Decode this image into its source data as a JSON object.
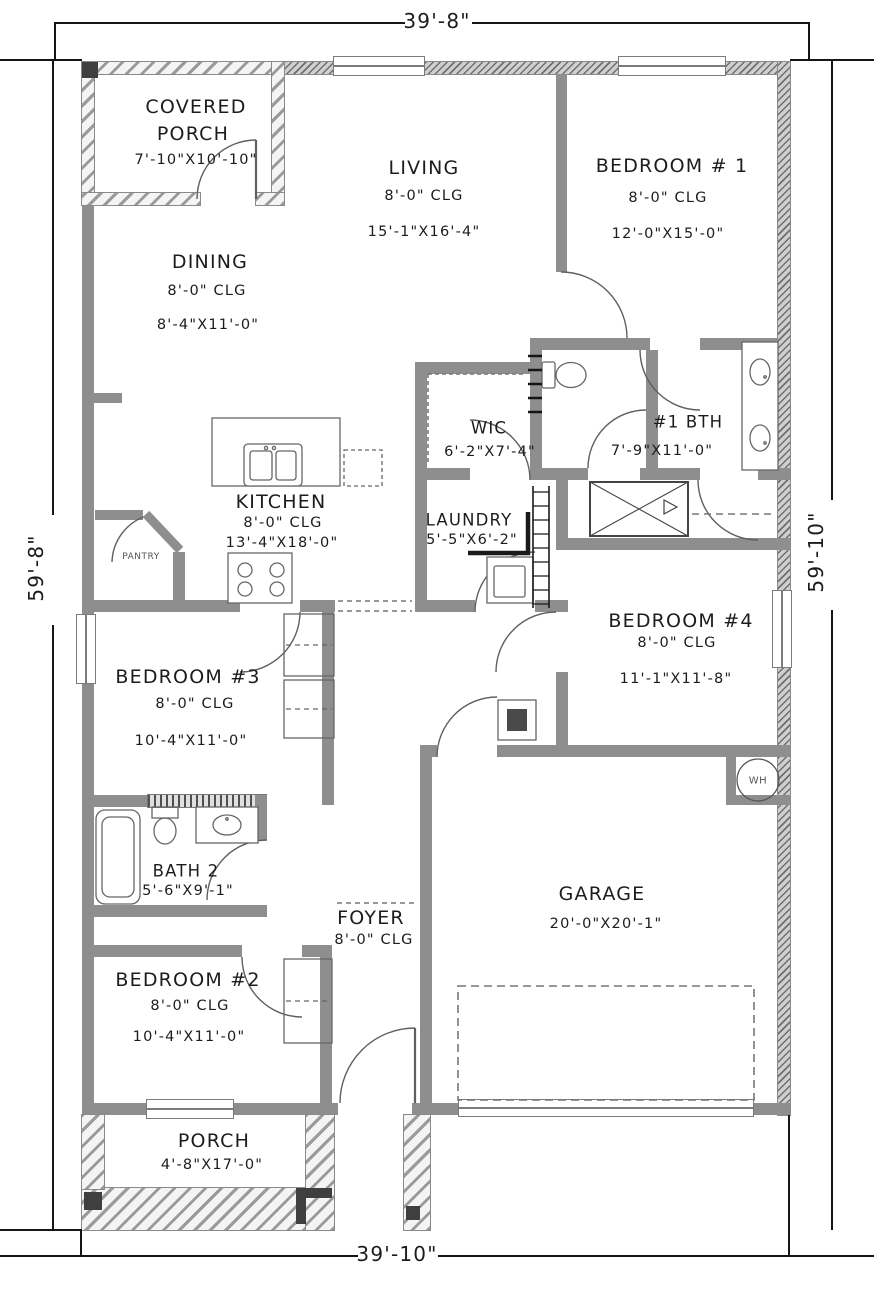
{
  "plan": {
    "type": "single-story-house-floor-plan"
  },
  "dimensions": {
    "top": "39'-8\"",
    "bottom": "39'-10\"",
    "left": "59'-8\"",
    "right": "59'-10\""
  },
  "rooms": {
    "covered_porch": {
      "line1": "COVERED",
      "line2": "PORCH",
      "size": "7'-10\"X10'-10\""
    },
    "living": {
      "name": "LIVING",
      "ceiling": "8'-0\" CLG",
      "size": "15'-1\"X16'-4\""
    },
    "bedroom1": {
      "name": "BEDROOM # 1",
      "ceiling": "8'-0\" CLG",
      "size": "12'-0\"X15'-0\""
    },
    "dining": {
      "name": "DINING",
      "ceiling": "8'-0\" CLG",
      "size": "8'-4\"X11'-0\""
    },
    "wic": {
      "name": "WIC",
      "size": "6'-2\"X7'-4\""
    },
    "bath1": {
      "name": "#1 BTH",
      "size": "7'-9\"X11'-0\""
    },
    "kitchen": {
      "name": "KITCHEN",
      "ceiling": "8'-0\" CLG",
      "size": "13'-4\"X18'-0\""
    },
    "pantry": {
      "name": "PANTRY"
    },
    "laundry": {
      "name": "LAUNDRY",
      "size": "5'-5\"X6'-2\""
    },
    "bedroom4": {
      "name": "BEDROOM #4",
      "ceiling": "8'-0\" CLG",
      "size": "11'-1\"X11'-8\""
    },
    "bedroom3": {
      "name": "BEDROOM #3",
      "ceiling": "8'-0\" CLG",
      "size": "10'-4\"X11'-0\""
    },
    "bath2": {
      "name": "BATH 2",
      "size": "5'-6\"X9'-1\""
    },
    "foyer": {
      "name": "FOYER",
      "ceiling": "8'-0\" CLG"
    },
    "garage": {
      "name": "GARAGE",
      "size": "20'-0\"X20'-1\""
    },
    "bedroom2": {
      "name": "BEDROOM #2",
      "ceiling": "8'-0\" CLG",
      "size": "10'-4\"X11'-0\""
    },
    "porch": {
      "name": "PORCH",
      "size": "4'-8\"X17'-0\""
    }
  },
  "labels": {
    "water_heater": "WH"
  },
  "colors": {
    "wall": "#8e8e8e",
    "line": "#5f5f5f",
    "text": "#1c1c1c",
    "background": "#ffffff"
  }
}
